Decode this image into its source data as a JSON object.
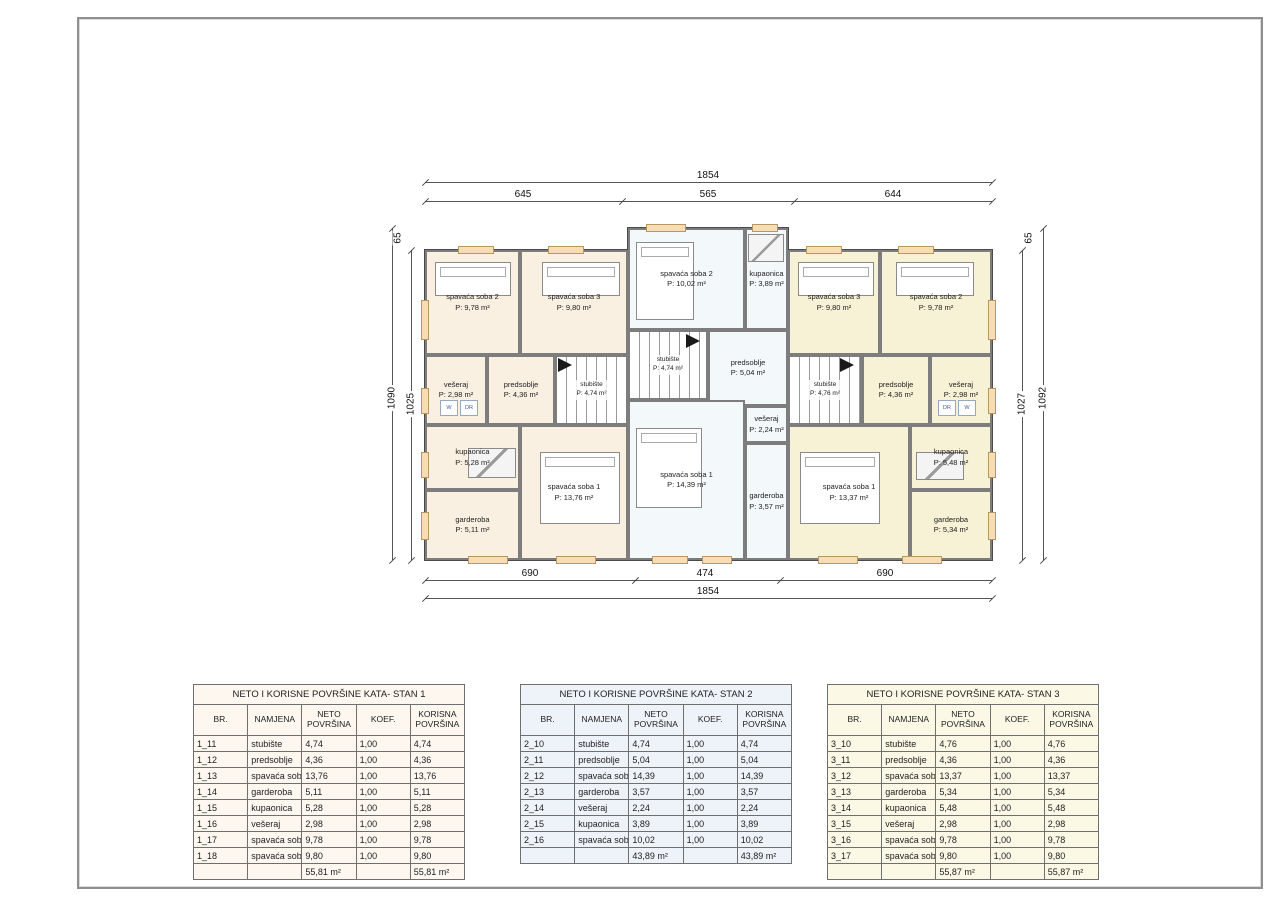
{
  "dimensions": {
    "top": {
      "total": "1854",
      "segments": [
        "645",
        "565",
        "644"
      ]
    },
    "bottom": {
      "segments": [
        "690",
        "474",
        "690"
      ],
      "total": "1854"
    },
    "left": {
      "offset": "65",
      "outer": "1090",
      "inner": "1025"
    },
    "right": {
      "offset": "65",
      "inner": "1027",
      "outer": "1092"
    }
  },
  "floorplan": {
    "colors": {
      "stan1_fill": "#faf0e2",
      "stan2_fill": "#f3f8fb",
      "stan3_fill": "#f7f2d5",
      "wall": "#9c9c9c",
      "window": "#f6ddb6"
    },
    "apartments": [
      {
        "id": "stan1",
        "rooms": [
          {
            "id": "s1-soba2",
            "name": "spavaća soba 2",
            "area": "P: 9,78 m²"
          },
          {
            "id": "s1-soba3",
            "name": "spavaća soba 3",
            "area": "P: 9,80 m²"
          },
          {
            "id": "s1-veseraj",
            "name": "vešeraj",
            "area": "P: 2,98 m²"
          },
          {
            "id": "s1-predsoblje",
            "name": "predsoblje",
            "area": "P: 4,36 m²"
          },
          {
            "id": "s1-stubiste",
            "name": "stubište",
            "area": "P: 4,74 m²"
          },
          {
            "id": "s1-kupaonica",
            "name": "kupaonica",
            "area": "P: 5,28 m²"
          },
          {
            "id": "s1-garderoba",
            "name": "garderoba",
            "area": "P: 5,11 m²"
          },
          {
            "id": "s1-soba1",
            "name": "spavaća soba 1",
            "area": "P: 13,76 m²"
          }
        ],
        "appliances": [
          {
            "id": "s1-w",
            "label": "W"
          },
          {
            "id": "s1-dr",
            "label": "DR"
          }
        ]
      },
      {
        "id": "stan2",
        "rooms": [
          {
            "id": "s2-soba2",
            "name": "spavaća soba 2",
            "area": "P: 10,02 m²"
          },
          {
            "id": "s2-kupaonica",
            "name": "kupaonica",
            "area": "P: 3,89 m²"
          },
          {
            "id": "s2-stubiste",
            "name": "stubište",
            "area": "P: 4,74 m²"
          },
          {
            "id": "s2-predsoblje",
            "name": "predsoblje",
            "area": "P: 5,04 m²"
          },
          {
            "id": "s2-veseraj",
            "name": "vešeraj",
            "area": "P: 2,24 m²"
          },
          {
            "id": "s2-garderoba",
            "name": "garderoba",
            "area": "P: 3,57 m²"
          },
          {
            "id": "s2-soba1",
            "name": "spavaća soba 1",
            "area": "P: 14,39 m²"
          }
        ],
        "appliances": []
      },
      {
        "id": "stan3",
        "rooms": [
          {
            "id": "s3-soba3",
            "name": "spavaća soba 3",
            "area": "P: 9,80 m²"
          },
          {
            "id": "s3-soba2",
            "name": "spavaća soba 2",
            "area": "P: 9,78 m²"
          },
          {
            "id": "s3-stubiste",
            "name": "stubište",
            "area": "P: 4,76 m²"
          },
          {
            "id": "s3-predsoblje",
            "name": "predsoblje",
            "area": "P: 4,36 m²"
          },
          {
            "id": "s3-veseraj",
            "name": "vešeraj",
            "area": "P: 2,98 m²"
          },
          {
            "id": "s3-soba1",
            "name": "spavaća soba 1",
            "area": "P: 13,37 m²"
          },
          {
            "id": "s3-kupaonica",
            "name": "kupaonica",
            "area": "P: 5,48 m²"
          },
          {
            "id": "s3-garderoba",
            "name": "garderoba",
            "area": "P: 5,34 m²"
          }
        ],
        "appliances": [
          {
            "id": "s3-dr",
            "label": "DR"
          },
          {
            "id": "s3-w",
            "label": "W"
          }
        ]
      }
    ]
  },
  "tables": [
    {
      "id": "stan1",
      "title": "NETO I KORISNE POVRŠINE KATA- STAN 1",
      "headers": [
        "BR.",
        "NAMJENA",
        "NETO POVRŠINA",
        "KOEF.",
        "KORISNA POVRŠINA"
      ],
      "rows": [
        [
          "1_11",
          "stubište",
          "4,74",
          "1,00",
          "4,74"
        ],
        [
          "1_12",
          "predsoblje",
          "4,36",
          "1,00",
          "4,36"
        ],
        [
          "1_13",
          "spavaća soba 1",
          "13,76",
          "1,00",
          "13,76"
        ],
        [
          "1_14",
          "garderoba",
          "5,11",
          "1,00",
          "5,11"
        ],
        [
          "1_15",
          "kupaonica",
          "5,28",
          "1,00",
          "5,28"
        ],
        [
          "1_16",
          "vešeraj",
          "2,98",
          "1,00",
          "2,98"
        ],
        [
          "1_17",
          "spavaća soba 2",
          "9,78",
          "1,00",
          "9,78"
        ],
        [
          "1_18",
          "spavaća soba 3",
          "9,80",
          "1,00",
          "9,80"
        ]
      ],
      "total_neto": "55,81 m²",
      "total_korisna": "55,81 m²",
      "tint": "#fdf7f0"
    },
    {
      "id": "stan2",
      "title": "NETO I KORISNE POVRŠINE KATA- STAN 2",
      "headers": [
        "BR.",
        "NAMJENA",
        "NETO POVRŠINA",
        "KOEF.",
        "KORISNA POVRŠINA"
      ],
      "rows": [
        [
          "2_10",
          "stubište",
          "4,74",
          "1,00",
          "4,74"
        ],
        [
          "2_11",
          "predsoblje",
          "5,04",
          "1,00",
          "5,04"
        ],
        [
          "2_12",
          "spavaća soba 1",
          "14,39",
          "1,00",
          "14,39"
        ],
        [
          "2_13",
          "garderoba",
          "3,57",
          "1,00",
          "3,57"
        ],
        [
          "2_14",
          "vešeraj",
          "2,24",
          "1,00",
          "2,24"
        ],
        [
          "2_15",
          "kupaonica",
          "3,89",
          "1,00",
          "3,89"
        ],
        [
          "2_16",
          "spavaća soba 2",
          "10,02",
          "1,00",
          "10,02"
        ]
      ],
      "total_neto": "43,89 m²",
      "total_korisna": "43,89 m²",
      "tint": "#eef3f9"
    },
    {
      "id": "stan3",
      "title": "NETO I KORISNE POVRŠINE KATA- STAN 3",
      "headers": [
        "BR.",
        "NAMJENA",
        "NETO POVRŠINA",
        "KOEF.",
        "KORISNA POVRŠINA"
      ],
      "rows": [
        [
          "3_10",
          "stubište",
          "4,76",
          "1,00",
          "4,76"
        ],
        [
          "3_11",
          "predsoblje",
          "4,36",
          "1,00",
          "4,36"
        ],
        [
          "3_12",
          "spavaća soba 1",
          "13,37",
          "1,00",
          "13,37"
        ],
        [
          "3_13",
          "garderoba",
          "5,34",
          "1,00",
          "5,34"
        ],
        [
          "3_14",
          "kupaonica",
          "5,48",
          "1,00",
          "5,48"
        ],
        [
          "3_15",
          "vešeraj",
          "2,98",
          "1,00",
          "2,98"
        ],
        [
          "3_16",
          "spavaća soba 2",
          "9,78",
          "1,00",
          "9,78"
        ],
        [
          "3_17",
          "spavaća soba 3",
          "9,80",
          "1,00",
          "9,80"
        ]
      ],
      "total_neto": "55,87 m²",
      "total_korisna": "55,87 m²",
      "tint": "#fbf8e6"
    }
  ]
}
